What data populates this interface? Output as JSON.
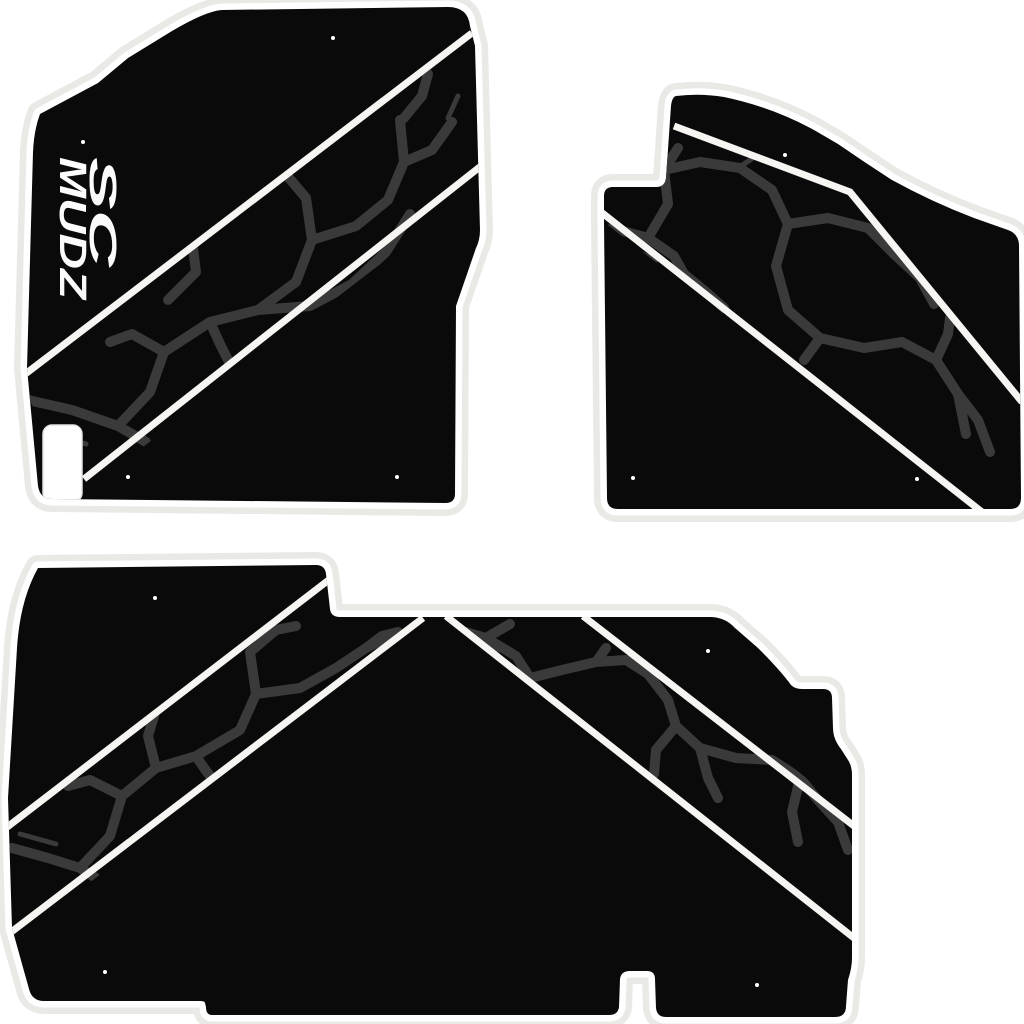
{
  "logo": {
    "line1": "SC",
    "line2": "MUDZ"
  },
  "colors": {
    "background": "#ffffff",
    "mat-black": "#0a0a0a",
    "crack-gray": "#3a3a3a",
    "stripe-white": "#f7f5f1",
    "outline-gray": "#e9e9e6",
    "edge-white": "#ffffff",
    "logo-white": "#fbfbfb",
    "dot-white": "#ffffff",
    "heel-pad-white": "#ffffff"
  },
  "mats": {
    "driver_front": "driver front floor mat",
    "passenger_front": "passenger front floor mat",
    "rear_bench": "rear bench floor mat"
  }
}
